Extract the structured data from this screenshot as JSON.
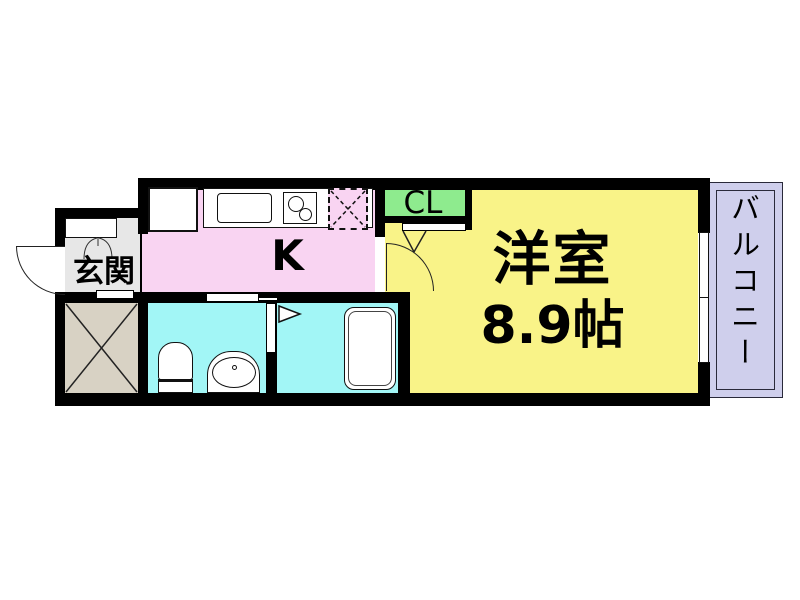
{
  "floorplan": {
    "rooms": {
      "entrance": {
        "label": "玄関"
      },
      "kitchen": {
        "label": "K"
      },
      "closet": {
        "label": "CL"
      },
      "western_room": {
        "label": "洋室",
        "area": "8.9帖"
      },
      "balcony": {
        "label": "バルコニー"
      }
    },
    "colors": {
      "wall": "#000000",
      "western_room": "#f9f388",
      "kitchen": "#f9d4f2",
      "entrance": "#e7e7e7",
      "bathroom": "#a2f6f6",
      "closet": "#8eeb8e",
      "balcony": "#cfcfec",
      "shaft": "#d8d2c4"
    }
  }
}
